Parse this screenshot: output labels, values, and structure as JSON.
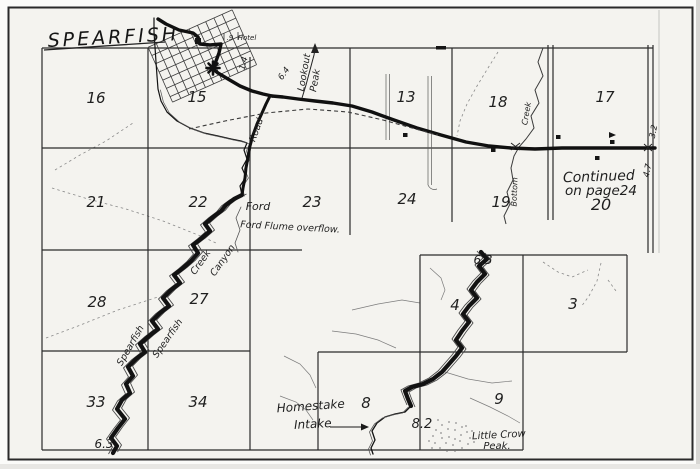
{
  "map": {
    "title": "SPEARFISH",
    "sections": {
      "s16": "16",
      "s15": "15",
      "s13": "13",
      "s18": "18",
      "s17": "17",
      "s21": "21",
      "s22": "22",
      "s23": "23",
      "s24": "24",
      "s19": "19",
      "s20": "20",
      "s28": "28",
      "s27": "27",
      "s33": "33",
      "s34": "34",
      "s4": "4",
      "s3": "3",
      "s8": "8",
      "s9": "9"
    },
    "labels": {
      "lookout_line1": "Lookout",
      "lookout_line2": "Peak",
      "road": "Road",
      "ford": "Ford",
      "ford_flume": "Ford Flume overflow.",
      "spearfish_west": "Spearfish",
      "creek_west": "Creek",
      "spearfish_east": "Spearfish",
      "canyon_east": "Canyon",
      "false_bottom_creek": "Creek",
      "false_bottom": "Bottom",
      "hotel": "Hotel",
      "continued_line1": "Continued",
      "continued_line2": "on page24",
      "homestake_line1": "Homestake",
      "homestake_line2": "Intake",
      "little_crow_line1": "Little Crow",
      "little_crow_line2": "Peak."
    },
    "mileages": {
      "hotel_mi": ".9",
      "town_mi": "1.4",
      "road_mi": "6.4",
      "east_mi_upper": "3.2",
      "east_mi_lower": "4.7",
      "creek_mi_sw": "6.3",
      "creek_mi_block": "6.3",
      "creek_mi_intake": "8.2"
    }
  }
}
